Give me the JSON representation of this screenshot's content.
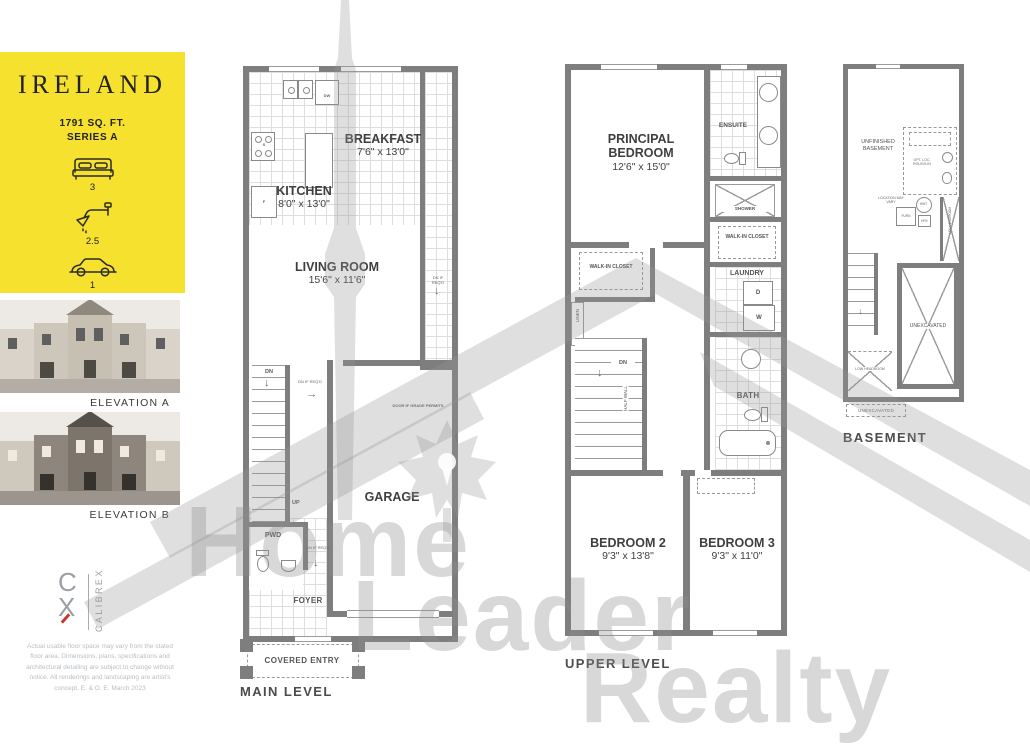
{
  "colors": {
    "accent_yellow": "#F5E12E",
    "wall_gray": "#7E7E7E",
    "grid_gray": "#DEDEDE",
    "watermark_gray": "#D2D2D2",
    "logo_red": "#C23B2E",
    "text_dark": "#3D3D3D"
  },
  "sidebar": {
    "title": "IRELAND",
    "sqft": "1791 SQ. FT.",
    "series": "SERIES A",
    "beds": "3",
    "baths": "2.5",
    "cars": "1",
    "elevation_a": "ELEVATION A",
    "elevation_b": "ELEVATION B",
    "logo": {
      "c": "C",
      "x": "X",
      "brand": "CALIBREX"
    },
    "disclaimer": "Actual usable floor space may vary from the stated floor area. Dimensions, plans, specifications and architectural detailing are subject to change without notice. All renderings and landscaping are artist's concept. E. & O. E. March 2023"
  },
  "watermark": {
    "word1": "Home",
    "word2": "Leader",
    "word3": "Realty"
  },
  "main": {
    "label": "MAIN LEVEL",
    "breakfast_name": "BREAKFAST",
    "breakfast_dims": "7'6\" x 13'0\"",
    "kitchen_name": "KITCHEN",
    "kitchen_dims": "8'0\" x 13'0\"",
    "living_name": "LIVING ROOM",
    "living_dims": "15'6\" x 11'6\"",
    "garage": "GARAGE",
    "pwd": "PWD",
    "foyer": "FOYER",
    "covered_entry": "COVERED ENTRY",
    "dn": "DN",
    "up": "UP",
    "dw": "DW",
    "stove": "S",
    "fridge": "F",
    "dn_if_reqd": "DN IF REQ'D",
    "door_if_grade": "DOOR IF GRADE PERMITS"
  },
  "upper": {
    "label": "UPPER LEVEL",
    "principal_name": "PRINCIPAL BEDROOM",
    "principal_dims": "12'6\" x 15'0\"",
    "ensuite": "ENSUITE",
    "shower": "SHOWER",
    "walkin": "WALK-IN CLOSET",
    "laundry": "LAUNDRY",
    "dryer": "D",
    "washer": "W",
    "linen": "LINEN",
    "dn": "DN",
    "half_wall": "HALF WALL",
    "bath": "BATH",
    "bedroom2_name": "BEDROOM 2",
    "bedroom2_dims": "9'3\" x 13'8\"",
    "bedroom3_name": "BEDROOM 3",
    "bedroom3_dims": "9'3\" x 11'0\""
  },
  "basement": {
    "label": "BASEMENT",
    "unfinished": "UNFINISHED BASEMENT",
    "opt_rough_in": "OPT. LOC. ROUGH-IN",
    "location_may_vary": "LOCATION MAY VARY",
    "hwt": "HWT",
    "furn": "FURN",
    "hrv": "HRV",
    "low_headroom": "LOW HEADROOM",
    "unexcavated": "UNEXCAVATED"
  }
}
